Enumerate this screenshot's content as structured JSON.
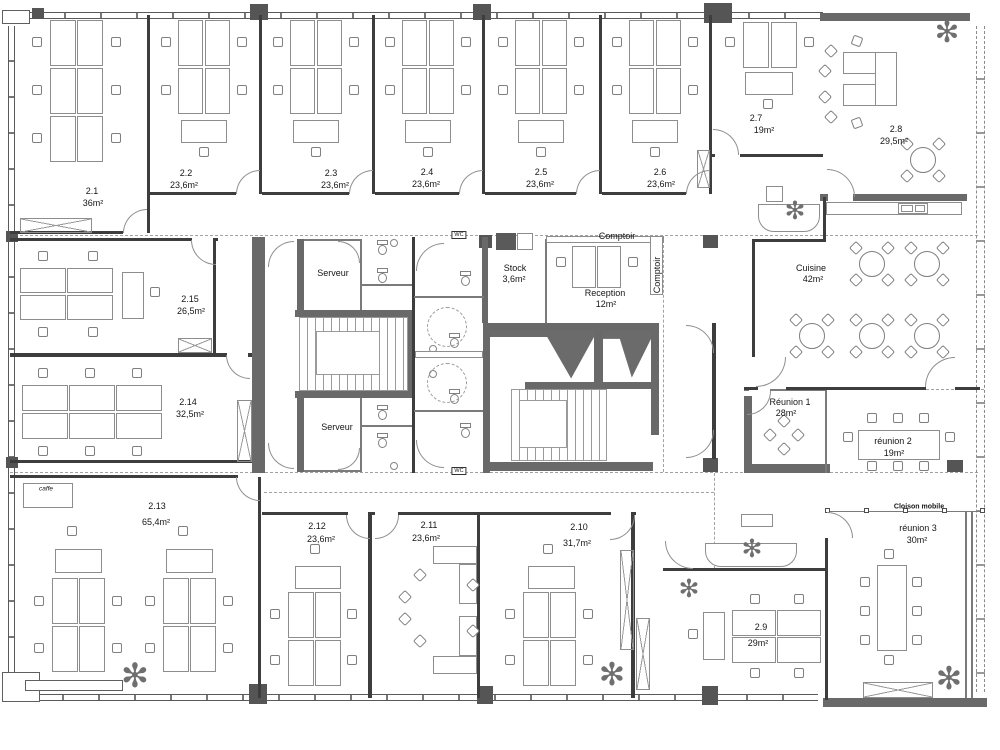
{
  "rooms": {
    "r2_1": {
      "id": "2.1",
      "area": "36m²"
    },
    "r2_2": {
      "id": "2.2",
      "area": "23,6m²"
    },
    "r2_3": {
      "id": "2.3",
      "area": "23,6m²"
    },
    "r2_4": {
      "id": "2.4",
      "area": "23,6m²"
    },
    "r2_5": {
      "id": "2.5",
      "area": "23,6m²"
    },
    "r2_6": {
      "id": "2.6",
      "area": "23,6m²"
    },
    "r2_7": {
      "id": "2.7",
      "area": "19m²"
    },
    "r2_8": {
      "id": "2.8",
      "area": "29,5m²"
    },
    "r2_9": {
      "id": "2.9",
      "area": "29m²"
    },
    "r2_10": {
      "id": "2.10",
      "area": "31,7m²"
    },
    "r2_11": {
      "id": "2.11",
      "area": "23,6m²"
    },
    "r2_12": {
      "id": "2.12",
      "area": "23,6m²"
    },
    "r2_13": {
      "id": "2.13",
      "area": "65,4m²"
    },
    "r2_14": {
      "id": "2.14",
      "area": "32,5m²"
    },
    "r2_15": {
      "id": "2.15",
      "area": "26,5m²"
    },
    "serveur_top": {
      "name": "Serveur"
    },
    "serveur_bottom": {
      "name": "Serveur"
    },
    "stock": {
      "name": "Stock",
      "area": "3,6m²"
    },
    "reception": {
      "name": "Reception",
      "area": "12m²"
    },
    "cuisine": {
      "name": "Cuisine",
      "area": "42m²"
    },
    "reunion1": {
      "name": "Réunion 1",
      "area": "28m²"
    },
    "reunion2": {
      "name": "réunion 2",
      "area": "19m²"
    },
    "reunion3": {
      "name": "réunion 3",
      "area": "30m²"
    }
  },
  "labels": {
    "comptoir_top": "Comptoir",
    "comptoir_side": "Comptoir",
    "cloison_mobile": "Cloison mobile",
    "caffe": "caffe",
    "wc": "WC"
  },
  "colors": {
    "wall_dark": "#696969",
    "wall_thin": "#3d3d3d",
    "furniture_line": "#8d8d8d",
    "dash": "#a2a2a2"
  }
}
